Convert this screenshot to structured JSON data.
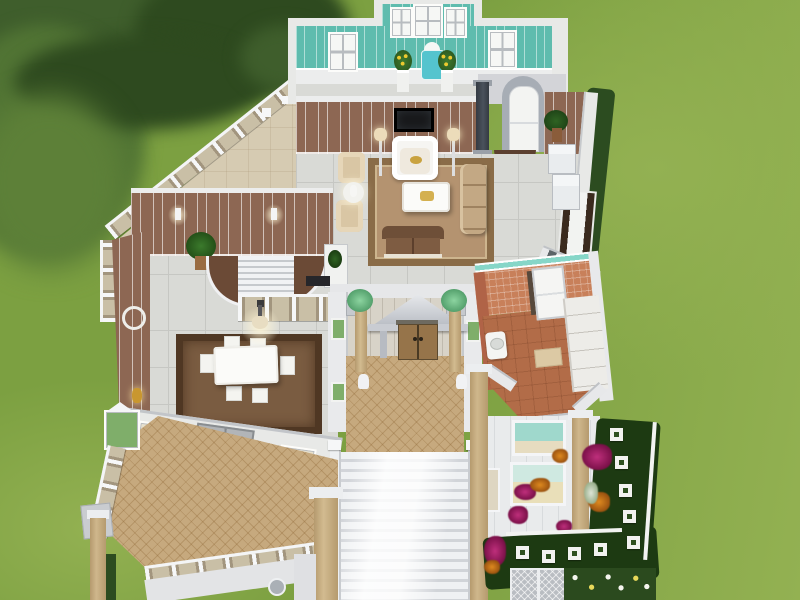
{
  "colors": {
    "grass": "#7ca041",
    "grassHi": "#93b152",
    "grassShade": "#5d8038",
    "tree": "#3f5e2c",
    "treeMid": "#517434",
    "treeDark": "#2e4a1f",
    "hedge": "#2c4c20",
    "wallWhite": "#e8e9e7",
    "wallGray": "#d3d4d8",
    "crown": "#eceded",
    "tealWall": "#5fbcae",
    "brownWall": "#8d6753",
    "tile": "#d9dad6",
    "tileLine": "#c6c7c3",
    "cream": "#d6cbb2",
    "rugTan": "#b49370",
    "rugBorder": "#8a6c48",
    "rugDiningField": "#7a5c41",
    "rugDiningBorder": "#4f3723",
    "parquet": "#c6a97e",
    "terraFloor": "#b26c48",
    "terraWall": "#c8805a",
    "tealTrim": "#86d6c8",
    "stair": "#eef0f2",
    "stairShadow": "#ced1d6",
    "woodDoor": "#96744a",
    "grayDoor": "#b2b5b8",
    "sofaBeige": "#c3a884",
    "sofaBrown": "#7e5c42",
    "tvDark": "#17181a",
    "colTan": "#c3a87e",
    "mint": "#8cd4a0",
    "magenta": "#bf2f7c",
    "orange": "#df8a1f",
    "gardenBed": "#1d3a12",
    "stone": "#f2f2f0",
    "plantGreen": "#3f7a2e"
  },
  "scene": {
    "view": "overhead-cutaway-floorplan",
    "environment": [
      "lawn",
      "trees",
      "hedges",
      "flower-garden"
    ],
    "rooms": [
      {
        "name": "vanity-room",
        "wall": "teal-paneled",
        "objects": [
          "bay-window",
          "side-windows",
          "vanity-chair",
          "sunflower-vase-left",
          "sunflower-vase-right",
          "pedestals"
        ]
      },
      {
        "name": "living-room",
        "wall": "brown-paneled",
        "objects": [
          "wall-tv",
          "white-settee",
          "floor-lamps",
          "area-rug",
          "coffee-table",
          "beige-sofa",
          "brown-loveseat",
          "armchairs",
          "side-table-lamp",
          "arched-doorway",
          "potted-palm",
          "half-round-rug",
          "white-cabinets",
          "curtained-window"
        ]
      },
      {
        "name": "stair-landing",
        "wall": "brown-paneled",
        "objects": [
          "curved-stairwell",
          "ornate-balustrade",
          "wall-sconces",
          "potted-palm",
          "white-console",
          "dark-console"
        ]
      },
      {
        "name": "dining-room",
        "objects": [
          "dining-table",
          "dining-chairs",
          "chandelier",
          "brown-area-rug",
          "gray-french-doors",
          "windows",
          "wall-medallion",
          "gold-sconce"
        ]
      },
      {
        "name": "entry-porch",
        "objects": [
          "pediment-portico",
          "wood-double-doors",
          "portico-columns",
          "planted-columns",
          "white-statues",
          "parquet-floor",
          "grand-staircase"
        ]
      },
      {
        "name": "bathroom",
        "wall": "terracotta-tile-teal-trim",
        "objects": [
          "white-door",
          "pedestal-sink",
          "vanity-counter",
          "bath-mat"
        ]
      },
      {
        "name": "front-balcony",
        "objects": [
          "parquet-floor",
          "ornate-balustrade",
          "gray-double-doors",
          "stone-columns",
          "round-window"
        ]
      },
      {
        "name": "upper-terrace",
        "objects": [
          "diagonal-balustrade",
          "cream-tile-floor"
        ]
      },
      {
        "name": "garden",
        "objects": [
          "stepping-stones",
          "magenta-flower-bushes",
          "orange-flower-bushes",
          "white-flower-border",
          "white-fence",
          "lattice-gates",
          "ground-floor-windows"
        ]
      }
    ],
    "counts": {
      "dining_chairs": 6,
      "stepping_stones": 9,
      "sunflower_vases": 2,
      "planted_columns": 2
    }
  }
}
